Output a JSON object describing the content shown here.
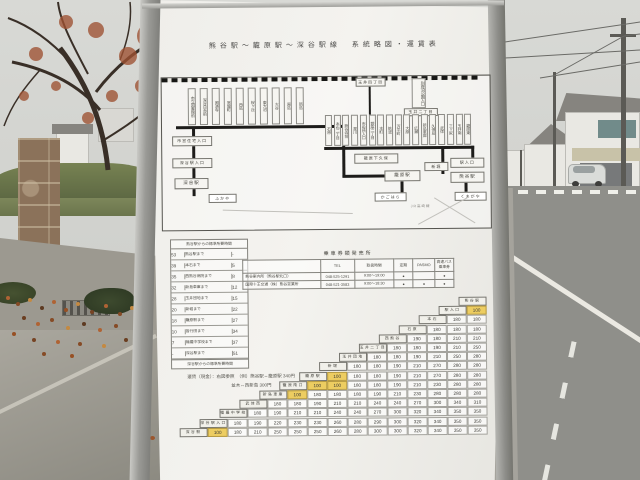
{
  "sign": {
    "title": "熊谷駅～籠原駅～深谷駅線　系統略図・運賃表",
    "map": {
      "jr_label": "JR高崎線",
      "jr_stations": [
        "ふかや",
        "かごはら",
        "くまがや"
      ],
      "left_branch": [
        "市営住宅入口",
        "深谷駅入口",
        "深谷駅"
      ],
      "mid_boxes": [
        "籠原下久保",
        "籠原駅"
      ],
      "top_boxes": [
        "玉井四丁目",
        "別府沼公園入口",
        "玉井二丁目",
        "新堀"
      ],
      "right_branch": [
        "駅入口",
        "熊谷駅"
      ],
      "left_row": [
        "市立図書館前",
        "深谷日赤前",
        "国済寺",
        "常盤町",
        "西島",
        "桜ヶ丘",
        "東大沼",
        "大谷",
        "原島",
        "新島"
      ],
      "right_row": [
        "石原",
        "本石二丁目",
        "熊谷寺前",
        "星川",
        "市役所入口",
        "銀座二丁目",
        "本町",
        "筑波",
        "万平町",
        "大原",
        "広瀬",
        "新島車庫",
        "久保島",
        "武体",
        "三ヶ尻",
        "玉井南",
        "籠原東"
      ]
    },
    "time_table": {
      "title": "熊谷駅からの標準所要時間",
      "footer": "深谷駅からの標準所要時間",
      "rows": [
        [
          "53",
          "熊谷駅まで",
          "-"
        ],
        [
          "39",
          "本石まで",
          "5"
        ],
        [
          "35",
          "西熊谷病院まで",
          "8"
        ],
        [
          "32",
          "新島車庫まで",
          "12"
        ],
        [
          "28",
          "玉井団地まで",
          "15"
        ],
        [
          "20",
          "新堀まで",
          "22"
        ],
        [
          "18",
          "籠原駅まで",
          "27"
        ],
        [
          "10",
          "皆行田まで",
          "34"
        ],
        [
          "7",
          "幡羅中学校まで",
          "37"
        ],
        [
          "-",
          "深谷駅まで",
          "51"
        ]
      ]
    },
    "ticket_table": {
      "title": "乗車券類発売所",
      "headers": [
        "",
        "TEL",
        "取扱時間",
        "定期",
        "PASMO",
        "高速バス乗車券"
      ],
      "rows": [
        {
          "name": "熊谷案内所（熊谷駅北口）",
          "tel": "048-525-1291",
          "hours": "9:00～19:00",
          "marks": [
            "●",
            "",
            "●"
          ]
        },
        {
          "name": "国際十王交通（株）熊谷営業所",
          "tel": "048-521-3583",
          "hours": "9:00～18:30",
          "marks": [
            "●",
            "●",
            "●"
          ]
        }
      ]
    },
    "fare_note": {
      "line1": "運賃（現金）：右図参照　（例）熊谷駅⇔籠原駅 340円",
      "line2": "並木⇔西新島 300円"
    },
    "fare_matrix": {
      "stations": [
        "熊谷駅",
        "駅入口",
        "本石",
        "石原",
        "西熊谷",
        "玉井二丁目",
        "玉井団地",
        "新堀",
        "籠原駅",
        "籠原南口",
        "新島車庫",
        "武体西",
        "幡羅中学校",
        "深谷駅入口",
        "深谷駅"
      ],
      "rows": [
        [],
        [
          "100*"
        ],
        [
          "180",
          "180"
        ],
        [
          "180",
          "180",
          "180"
        ],
        [
          "190",
          "180",
          "210",
          "210"
        ],
        [
          "180",
          "180",
          "190",
          "210",
          "250"
        ],
        [
          "180",
          "180",
          "190",
          "210",
          "250",
          "280"
        ],
        [
          "180",
          "180",
          "190",
          "210",
          "270",
          "280",
          "280"
        ],
        [
          "100*",
          "180",
          "180",
          "190",
          "210",
          "270",
          "280",
          "280"
        ],
        [
          "100*",
          "100*",
          "180",
          "180",
          "190",
          "210",
          "230",
          "280",
          "280"
        ],
        [
          "100*",
          "180",
          "180",
          "180",
          "190",
          "210",
          "230",
          "280",
          "280",
          "280"
        ],
        [
          "180",
          "180",
          "190",
          "210",
          "210",
          "240",
          "240",
          "270",
          "300",
          "340",
          "310"
        ],
        [
          "180",
          "190",
          "210",
          "210",
          "240",
          "240",
          "270",
          "300",
          "320",
          "340",
          "350",
          "350"
        ],
        [
          "180",
          "190",
          "220",
          "230",
          "230",
          "260",
          "280",
          "290",
          "300",
          "320",
          "340",
          "350",
          "350"
        ],
        [
          "100*",
          "180",
          "210",
          "250",
          "250",
          "250",
          "260",
          "280",
          "300",
          "300",
          "320",
          "340",
          "350",
          "350"
        ]
      ]
    }
  }
}
